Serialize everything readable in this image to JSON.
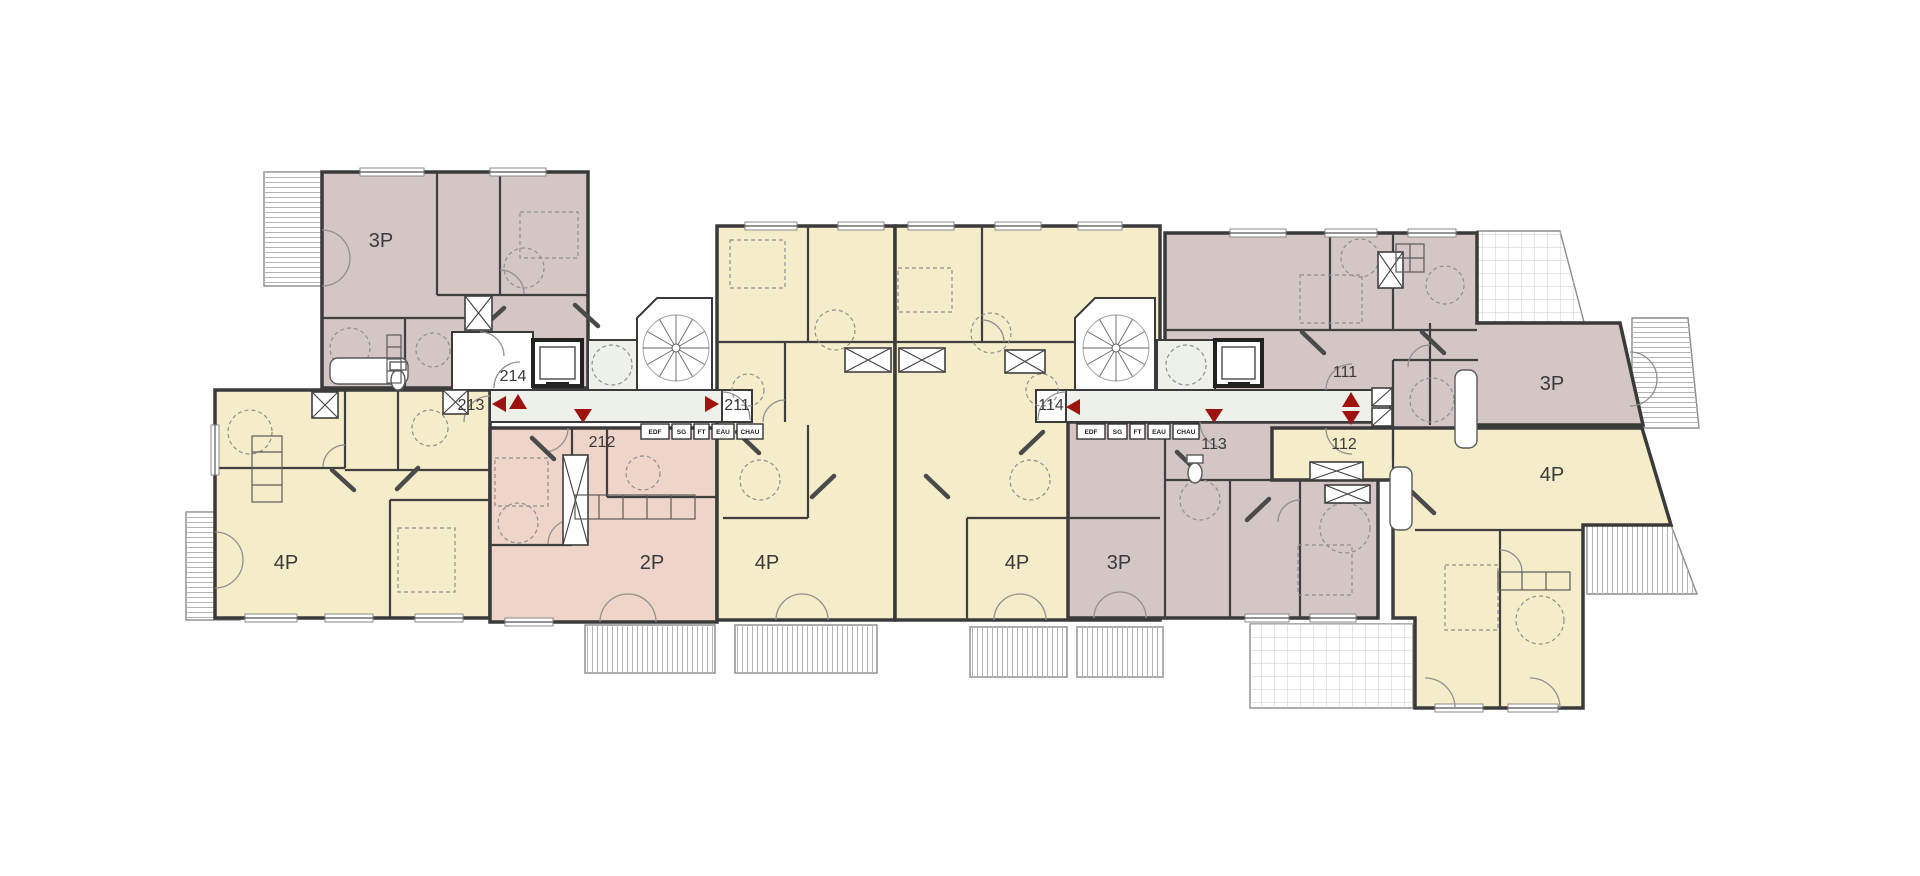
{
  "plan": {
    "units": [
      {
        "id": "214",
        "type": "3P"
      },
      {
        "id": "213",
        "type": "4P"
      },
      {
        "id": "212",
        "type": "2P"
      },
      {
        "id": "211",
        "type": "4P"
      },
      {
        "id": "114",
        "type": "4P"
      },
      {
        "id": "113",
        "type": "3P"
      },
      {
        "id": "112",
        "type": "4P"
      },
      {
        "id": "111",
        "type": "3P"
      }
    ],
    "utility_labels": [
      "EDF",
      "SG",
      "FT",
      "EAU",
      "CHAU"
    ],
    "colors": {
      "unit_3p": "#d3c6c4",
      "unit_4p": "#f5edc9",
      "unit_2p": "#eed4c9",
      "corridor": "#eef0ea",
      "marker_red": "#9e1310",
      "wall": "#3a3a3a"
    }
  }
}
